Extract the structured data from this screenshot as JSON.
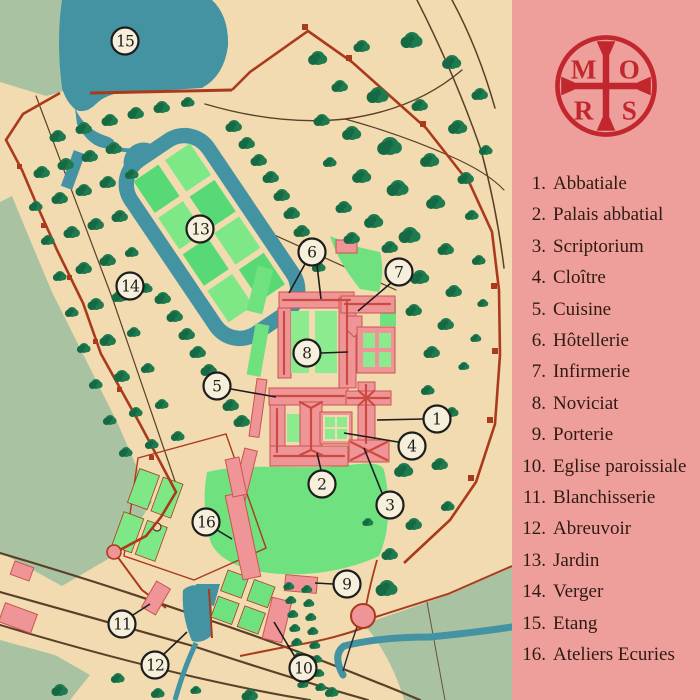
{
  "title": "Plan of an abbey estate",
  "panel": {
    "logo": {
      "letters": [
        "M",
        "O",
        "R",
        "S"
      ],
      "name": "MORS cross emblem"
    },
    "legend": [
      {
        "num": "1.",
        "label": "Abbatiale"
      },
      {
        "num": "2.",
        "label": "Palais abbatial"
      },
      {
        "num": "3.",
        "label": "Scriptorium"
      },
      {
        "num": "4.",
        "label": "Cloître"
      },
      {
        "num": "5.",
        "label": "Cuisine"
      },
      {
        "num": "6.",
        "label": "Hôtellerie"
      },
      {
        "num": "7.",
        "label": "Infirmerie"
      },
      {
        "num": "8.",
        "label": "Noviciat"
      },
      {
        "num": "9.",
        "label": "Porterie"
      },
      {
        "num": "10.",
        "label": "Eglise paroissiale"
      },
      {
        "num": "11.",
        "label": "Blanchisserie"
      },
      {
        "num": "12.",
        "label": "Abreuvoir"
      },
      {
        "num": "13.",
        "label": "Jardin"
      },
      {
        "num": "14.",
        "label": "Verger"
      },
      {
        "num": "15.",
        "label": "Etang"
      },
      {
        "num": "16.",
        "label": "Ateliers Ecuries"
      }
    ]
  },
  "map": {
    "markers": [
      {
        "n": "1",
        "x": 437,
        "y": 419,
        "lines": [
          [
            423,
            419,
            377,
            420
          ]
        ]
      },
      {
        "n": "2",
        "x": 322,
        "y": 484,
        "lines": [
          [
            321,
            470,
            317,
            453
          ]
        ]
      },
      {
        "n": "3",
        "x": 390,
        "y": 505,
        "lines": [
          [
            382,
            493,
            364,
            448
          ]
        ]
      },
      {
        "n": "4",
        "x": 412,
        "y": 446,
        "lines": [
          [
            398,
            442,
            344,
            433
          ]
        ]
      },
      {
        "n": "5",
        "x": 217,
        "y": 386,
        "lines": [
          [
            231,
            389,
            276,
            397
          ]
        ]
      },
      {
        "n": "6",
        "x": 312,
        "y": 252,
        "lines": [
          [
            305,
            264,
            289,
            293
          ],
          [
            317,
            265,
            321,
            299
          ]
        ]
      },
      {
        "n": "7",
        "x": 399,
        "y": 272,
        "lines": [
          [
            391,
            283,
            358,
            311
          ]
        ]
      },
      {
        "n": "8",
        "x": 307,
        "y": 353,
        "lines": [
          [
            321,
            353,
            348,
            352
          ]
        ]
      },
      {
        "n": "9",
        "x": 347,
        "y": 584,
        "lines": [
          [
            333,
            584,
            315,
            583
          ]
        ]
      },
      {
        "n": "10",
        "x": 303,
        "y": 668,
        "lines": [
          [
            295,
            657,
            274,
            622
          ]
        ]
      },
      {
        "n": "11",
        "x": 122,
        "y": 624,
        "lines": [
          [
            133,
            615,
            150,
            604
          ]
        ]
      },
      {
        "n": "12",
        "x": 155,
        "y": 665,
        "lines": [
          [
            164,
            654,
            187,
            632
          ]
        ]
      },
      {
        "n": "13",
        "x": 200,
        "y": 229,
        "lines": []
      },
      {
        "n": "14",
        "x": 130,
        "y": 286,
        "lines": []
      },
      {
        "n": "15",
        "x": 125,
        "y": 41,
        "lines": []
      },
      {
        "n": "16",
        "x": 206,
        "y": 522,
        "lines": [
          [
            217,
            530,
            232,
            539
          ]
        ]
      }
    ]
  },
  "colors": {
    "map_bg": "#f2dbb0",
    "water": "#4493a2",
    "field": "#a9c3a2",
    "lawn": "#6fe27f",
    "lawn_light": "#8cea8f",
    "bed1": "#57d976",
    "bed2": "#7ee886",
    "tree": "#1e7b4f",
    "tree_dark": "#156a43",
    "building": "#ef9597",
    "roof": "#cc4a42",
    "roof_dark": "#c9544e",
    "wall": "#ab3a1d",
    "road": "#5a4028",
    "ink": "#1d1d1d",
    "marker_fill": "#f6efdc",
    "panel_bg": "#ee9e9b",
    "logo_red": "#c1272d",
    "text_dark": "#2e1b12"
  }
}
